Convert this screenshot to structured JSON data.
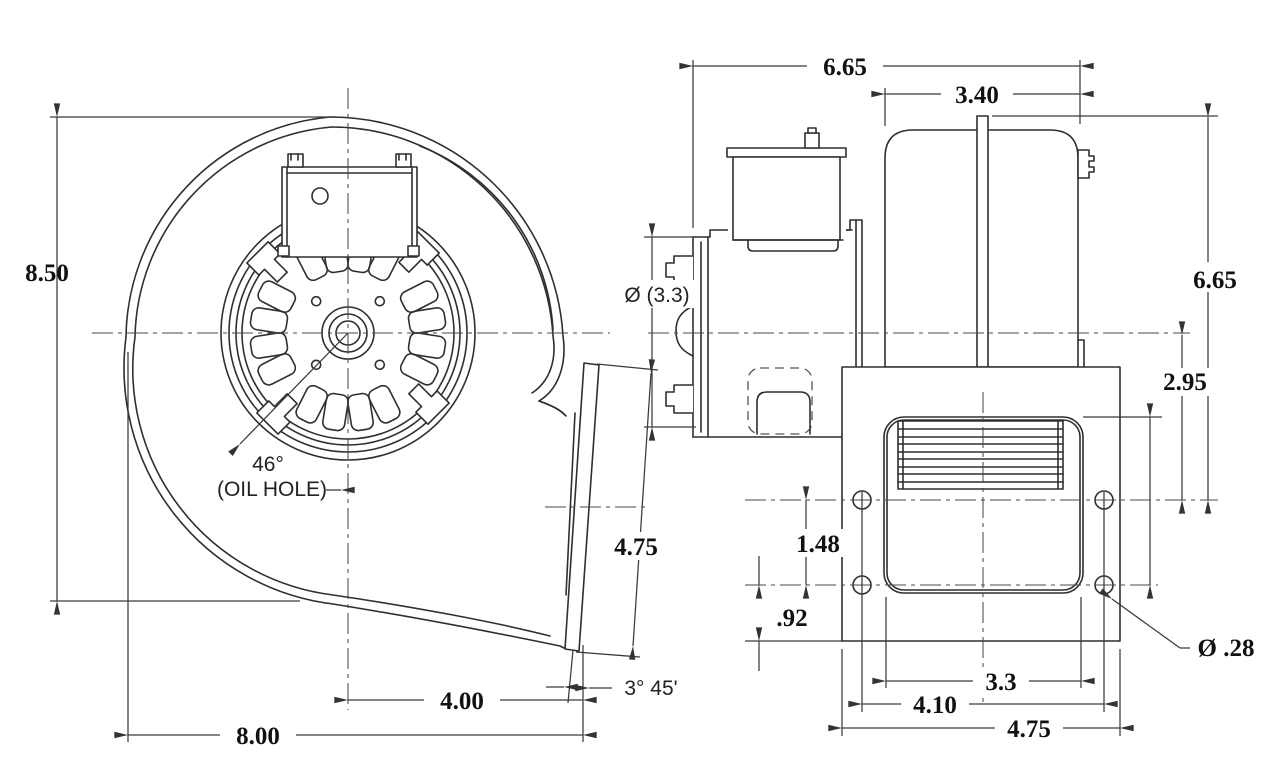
{
  "drawing": {
    "front_view": {
      "overall_height": "8.50",
      "overall_width": "8.00",
      "center_to_outlet": "4.00",
      "oil_hole_angle": "46°",
      "oil_hole_note": "(OIL HOLE)",
      "outlet_flange_length": "4.75",
      "outlet_flange_angle": "3° 45'"
    },
    "side_view": {
      "overall_depth": "6.65",
      "motor_depth": "3.40",
      "inlet_diameter": "Ø (3.3)",
      "overall_height": "6.65",
      "centerline_to_mount_holes": "2.95",
      "mount_hole_row_spacing": "1.48",
      "mount_holes_to_base": ".92",
      "outlet_opening_width": "3.3",
      "mount_hole_span": "4.10",
      "mount_flange_width": "4.75",
      "mount_hole_diameter": "Ø .28"
    }
  }
}
